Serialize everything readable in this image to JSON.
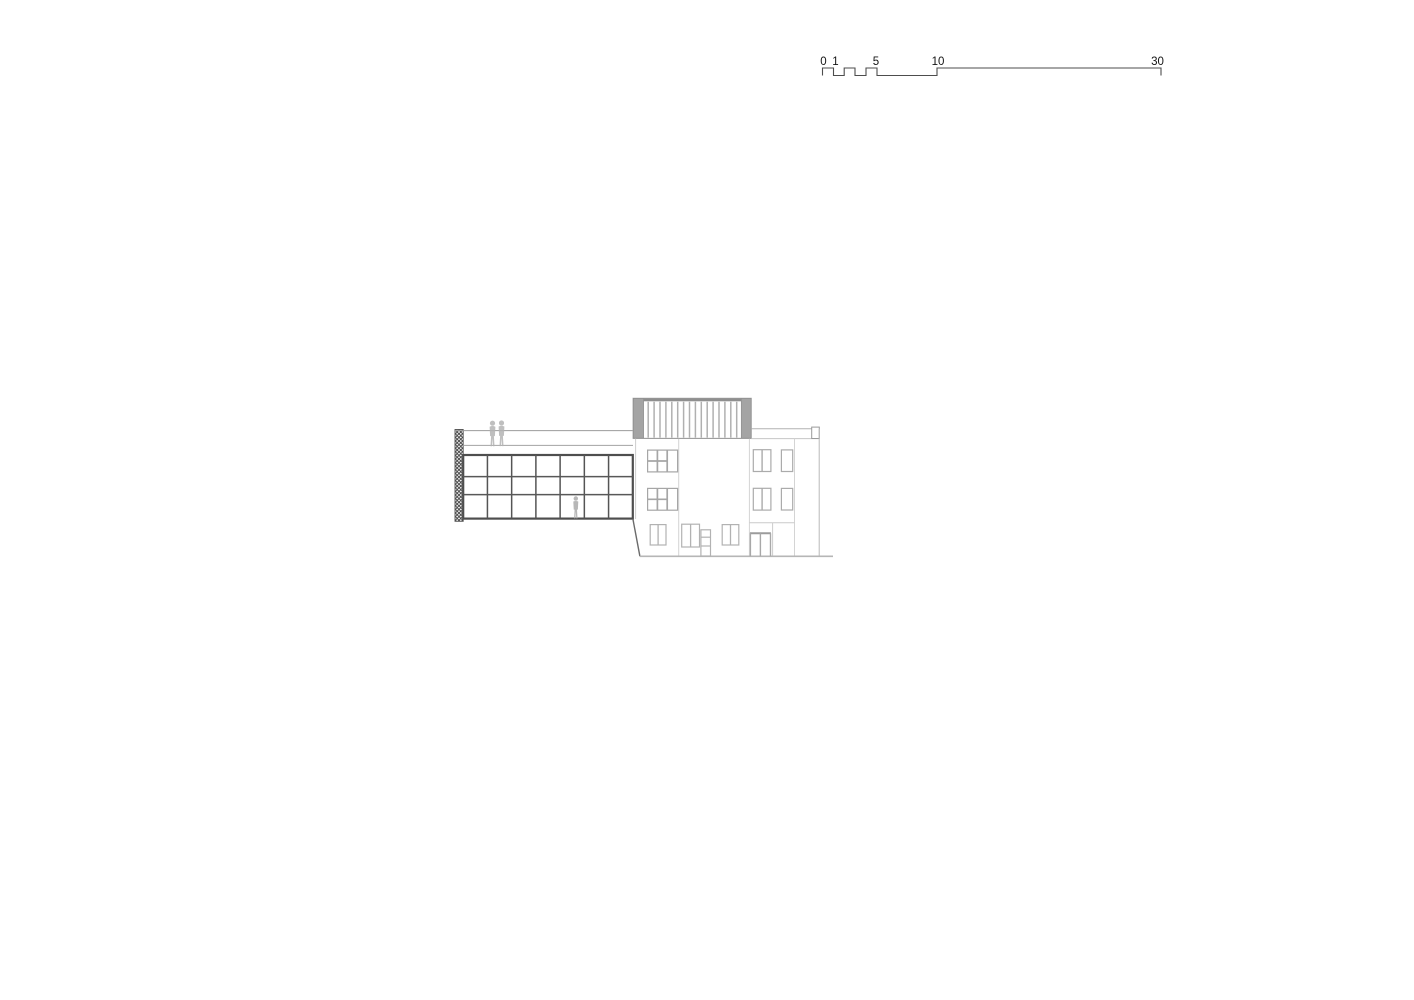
{
  "scale_bar": {
    "labels": [
      "0",
      "1",
      "5",
      "10",
      "30"
    ],
    "values_m": [
      0,
      1,
      5,
      10,
      30
    ],
    "line_color": "#4d4d4d",
    "text_color": "#141414"
  },
  "elevation": {
    "left_wing": {
      "grid_columns": 7,
      "grid_rows": 3,
      "roof_figures": 2,
      "interior_figures": 1
    },
    "right_wing": {
      "floors": 3,
      "upper_floor_composite_windows": 2,
      "right_bay_window_pairs": 2,
      "right_bay_single_windows": 2
    },
    "roof_louvers": {
      "slat_count": 16
    }
  },
  "colors": {
    "left_wing_lines": "#555555",
    "left_wing_border": "#4e4e4e",
    "roofline_gray": "#9c9c9c",
    "hatch_dark": "#3f3f3f",
    "right_wing_faint": "#c6c6c6",
    "right_wing_window": "#a6a6a6",
    "louver_panel": "#a4a4a4",
    "louver_band": "#8f8f8f",
    "figure_gray": "#b4b4b4",
    "ground_line": "#b6b6b6"
  }
}
